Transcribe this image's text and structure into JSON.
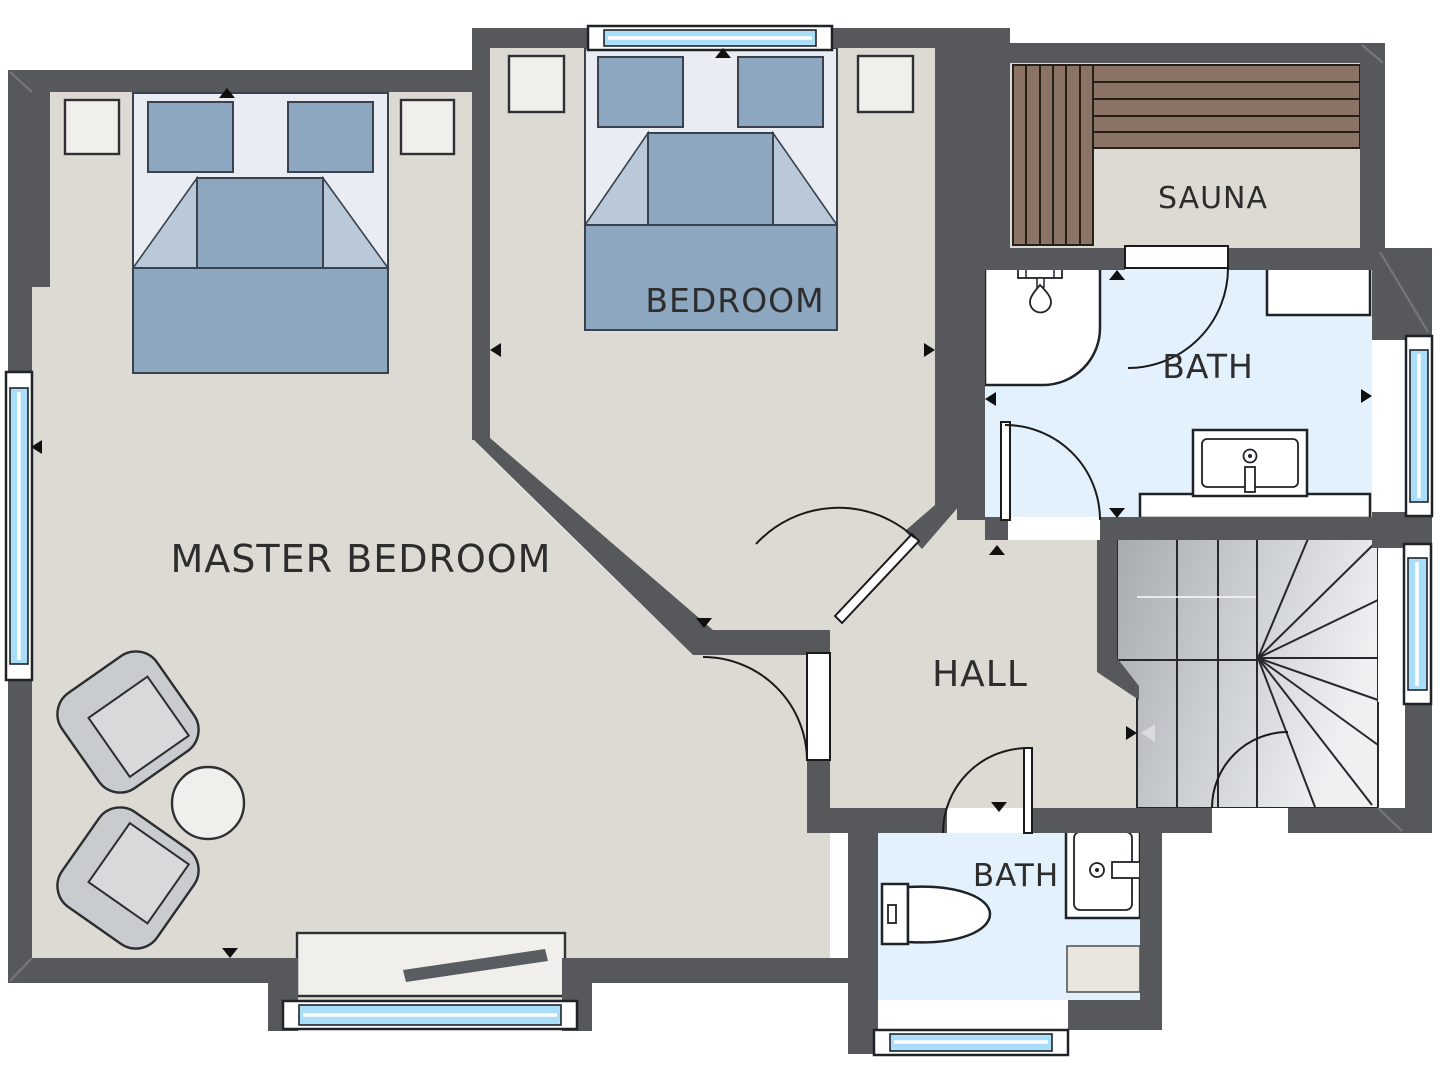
{
  "plan": {
    "type": "residential-floor-plan",
    "view": "top-down 2D with wall shadows"
  },
  "rooms": [
    {
      "name": "master-bedroom",
      "label": "MASTER BEDROOM"
    },
    {
      "name": "bedroom",
      "label": "BEDROOM"
    },
    {
      "name": "sauna",
      "label": "SAUNA"
    },
    {
      "name": "bath-upper",
      "label": "BATH"
    },
    {
      "name": "hall",
      "label": "HALL"
    },
    {
      "name": "bath-lower",
      "label": "BATH"
    }
  ],
  "furniture_icons": [
    "master-double-bed",
    "double-bed",
    "nightstand-left-master",
    "nightstand-right-master",
    "nightstand-left",
    "nightstand-right",
    "armchair-upper",
    "armchair-lower",
    "round-side-table",
    "sideboard",
    "sauna-bench-vertical",
    "sauna-bench-horizontal",
    "shower-stall",
    "shower-head",
    "washbasin-upper-bath",
    "wall-cabinet",
    "counter",
    "toilet",
    "washbasin-lower-bath",
    "bath-mat",
    "winder-staircase"
  ],
  "windows": {
    "count": 6,
    "locations": [
      "left-wall",
      "top-wall-bedroom",
      "bottom-bay-master",
      "right-wall-bath",
      "right-wall-stairs",
      "bottom-wall-bath"
    ]
  },
  "doors": {
    "count": 7,
    "swing_style": "quarter-arc"
  },
  "colors": {
    "wall": "#56585c",
    "wall_bevel": "#73767a",
    "floor": "#dcdad2",
    "bath_floor": "#e2f1fb",
    "window_glass": "#a9ddf8",
    "bed_blanket": "#8ca7bf",
    "bed_sheet": "#e9edf3",
    "bed_fold": "#b9c9d9",
    "wood": "#8b7365",
    "furniture": "#f1efeb",
    "chair": "#c9ccce",
    "stair_dark": "#a6abb0",
    "stair_light": "#eef0f2",
    "outline": "#1f2328",
    "text": "#2d2d2d"
  }
}
